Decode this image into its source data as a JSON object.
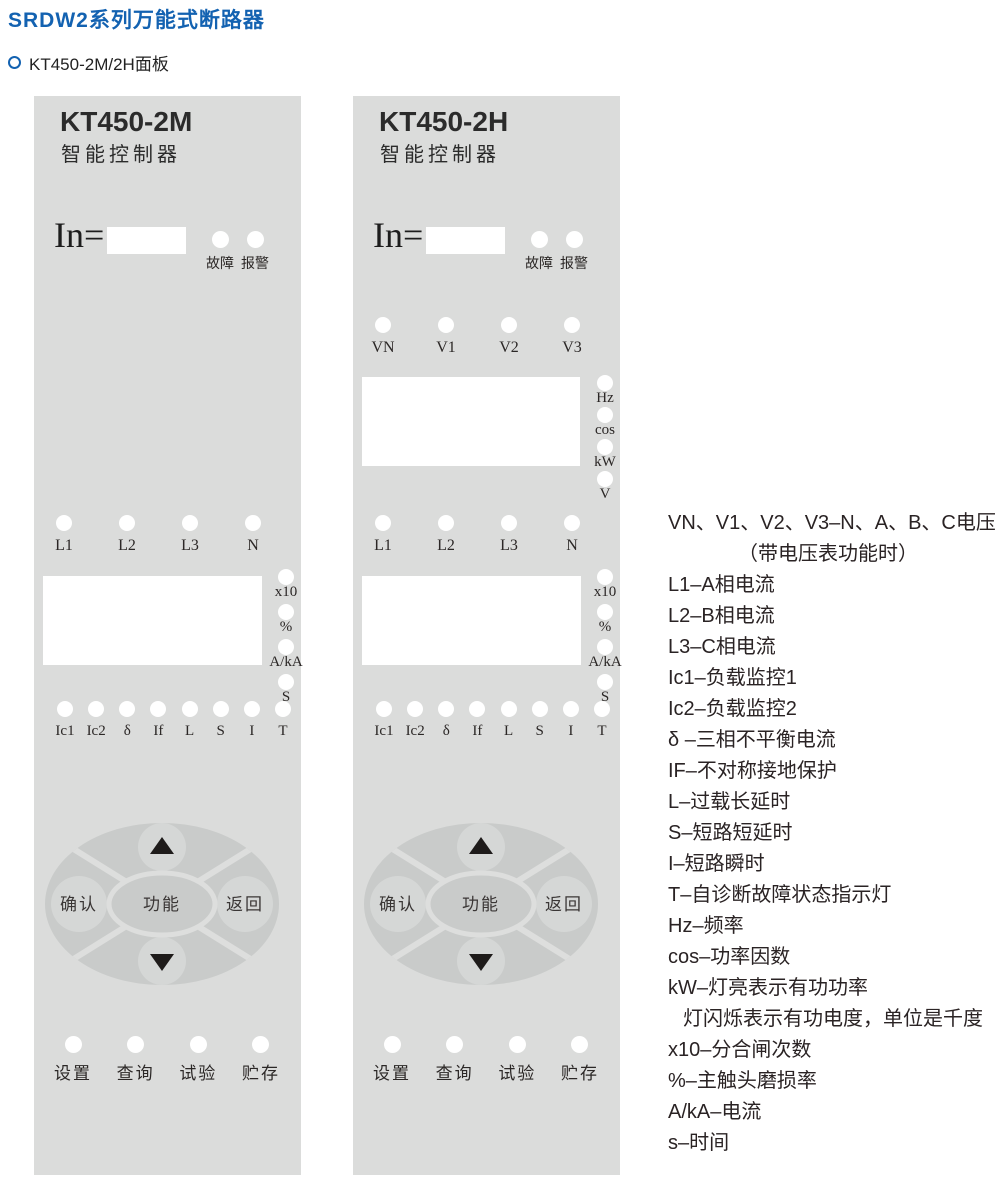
{
  "page": {
    "title": "SRDW2系列万能式断路器",
    "section_title": "KT450-2M/2H面板"
  },
  "colors": {
    "header_blue": "#1362b1",
    "panel_background": "#dbdcdb",
    "keypad_background": "#c9cbca",
    "keypad_button": "#d5d7d6",
    "keypad_divider": "#dddedd",
    "led": "#ffffff",
    "display": "#ffffff",
    "text_dark": "#2b2726"
  },
  "panels": [
    {
      "title": "KT450-2M",
      "subtitle": "智能控制器",
      "in_label": "In=",
      "status_leds": [
        "故障",
        "报警"
      ],
      "current_leds": [
        "L1",
        "L2",
        "L3",
        "N"
      ],
      "current_units": [
        "x10",
        "%",
        "A/kA",
        "S"
      ],
      "protection_leds": [
        "Ic1",
        "Ic2",
        "δ",
        "If",
        "L",
        "S",
        "I",
        "T"
      ],
      "keypad": {
        "up_icon": "triangle-up",
        "down_icon": "triangle-down",
        "confirm_label": "确认",
        "function_label": "功能",
        "return_label": "返回"
      },
      "bottom_leds": [
        "设置",
        "查询",
        "试验",
        "贮存"
      ]
    },
    {
      "title": "KT450-2H",
      "subtitle": "智能控制器",
      "in_label": "In=",
      "status_leds": [
        "故障",
        "报警"
      ],
      "voltage_leds": [
        "VN",
        "V1",
        "V2",
        "V3"
      ],
      "voltage_units": [
        "Hz",
        "cos",
        "kW",
        "V"
      ],
      "current_leds": [
        "L1",
        "L2",
        "L3",
        "N"
      ],
      "current_units": [
        "x10",
        "%",
        "A/kA",
        "S"
      ],
      "protection_leds": [
        "Ic1",
        "Ic2",
        "δ",
        "If",
        "L",
        "S",
        "I",
        "T"
      ],
      "keypad": {
        "up_icon": "triangle-up",
        "down_icon": "triangle-down",
        "confirm_label": "确认",
        "function_label": "功能",
        "return_label": "返回"
      },
      "bottom_leds": [
        "设置",
        "查询",
        "试验",
        "贮存"
      ]
    }
  ],
  "legend": {
    "lines": [
      {
        "text": "VN、V1、V2、V3–N、A、B、C电压",
        "indent": 0
      },
      {
        "text": "（带电压表功能时）",
        "indent": 1
      },
      {
        "text": "L1–A相电流",
        "indent": 0
      },
      {
        "text": "L2–B相电流",
        "indent": 0
      },
      {
        "text": "L3–C相电流",
        "indent": 0
      },
      {
        "text": "Ic1–负载监控1",
        "indent": 0
      },
      {
        "text": "Ic2–负载监控2",
        "indent": 0
      },
      {
        "text": "δ –三相不平衡电流",
        "indent": 0
      },
      {
        "text": "IF–不对称接地保护",
        "indent": 0
      },
      {
        "text": "L–过载长延时",
        "indent": 0
      },
      {
        "text": "S–短路短延时",
        "indent": 0
      },
      {
        "text": "I–短路瞬时",
        "indent": 0
      },
      {
        "text": "T–自诊断故障状态指示灯",
        "indent": 0
      },
      {
        "text": "Hz–频率",
        "indent": 0
      },
      {
        "text": "cos–功率因数",
        "indent": 0
      },
      {
        "text": "kW–灯亮表示有功功率",
        "indent": 0
      },
      {
        "text": "灯闪烁表示有功电度，单位是千度",
        "indent": 2
      },
      {
        "text": "x10–分合闸次数",
        "indent": 0
      },
      {
        "text": "%–主触头磨损率",
        "indent": 0
      },
      {
        "text": "A/kA–电流",
        "indent": 0
      },
      {
        "text": "s–时间",
        "indent": 0
      }
    ]
  }
}
